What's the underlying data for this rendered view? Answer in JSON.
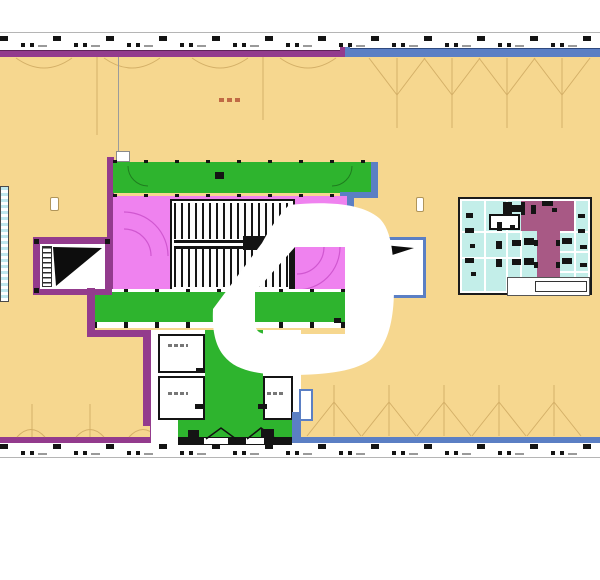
{
  "document": {
    "kind": "architectural floor plan screenshot",
    "title": "",
    "visible_text": [],
    "notes": "plan of an office floor with central stair core, lift lobby, and washroom block; large white logo watermark overlays the centre"
  },
  "colors": {
    "paper": "#ffffff",
    "yellow": "#f6d78f",
    "green": "#2eb42e",
    "pink": "#ef82ef",
    "purple": "#933b8d",
    "plum": "#a85985",
    "blue": "#5b7fc4",
    "cyan": "#c3eee9",
    "tan": "#c9a35b",
    "ink": "#141414"
  },
  "zones": {
    "open_office": {
      "label": "open floor area",
      "color": "#f6d78f"
    },
    "circulation": {
      "label": "corridors / lift lobby",
      "color": "#2eb42e"
    },
    "stair_core": {
      "label": "main stair core",
      "color": "#ef82ef"
    },
    "washrooms": {
      "label": "washroom block",
      "color": "#c3eee9"
    },
    "wc_lobby": {
      "label": "washroom lobby",
      "color": "#a85985"
    }
  },
  "watermark": {
    "name": "white-swirl-logo",
    "label": "logo watermark"
  }
}
